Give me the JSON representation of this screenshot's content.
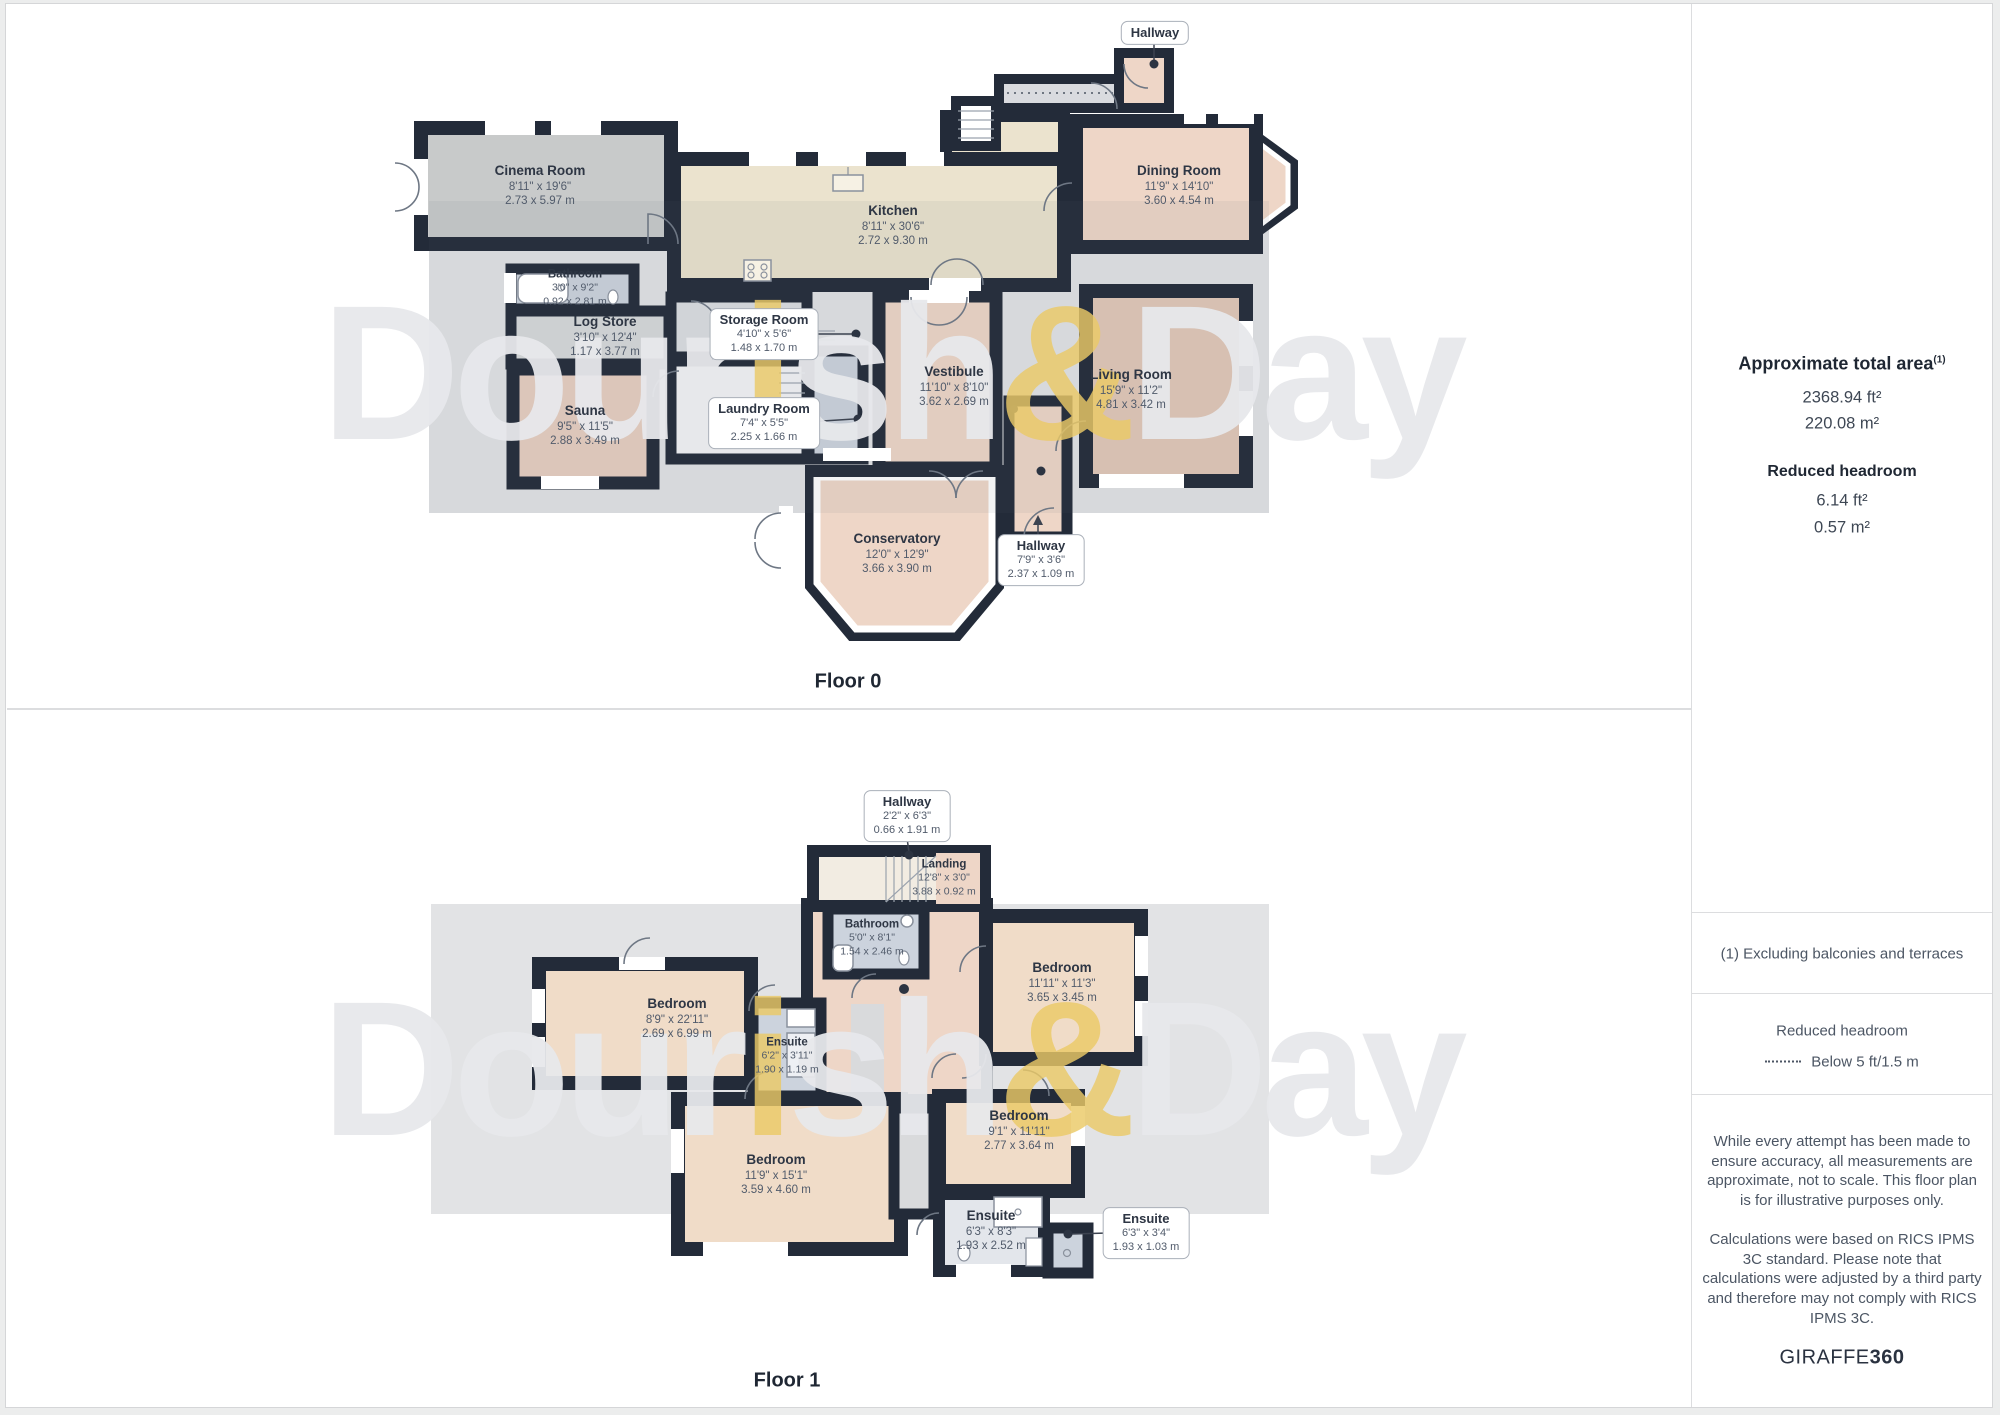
{
  "floor0": {
    "title": "Floor 0",
    "rooms": [
      {
        "name": "Cinema Room",
        "imperial": "8'11\" x 19'6\"",
        "metric": "2.73 x 5.97 m"
      },
      {
        "name": "Kitchen",
        "imperial": "8'11\" x 30'6\"",
        "metric": "2.72 x 9.30 m"
      },
      {
        "name": "Dining Room",
        "imperial": "11'9\" x 14'10\"",
        "metric": "3.60 x 4.54 m"
      },
      {
        "name": "Bathroom",
        "imperial": "3'0\" x 9'2\"",
        "metric": "0.92 x 2.81 m"
      },
      {
        "name": "Log Store",
        "imperial": "3'10\" x 12'4\"",
        "metric": "1.17 x 3.77 m"
      },
      {
        "name": "Sauna",
        "imperial": "9'5\" x 11'5\"",
        "metric": "2.88 x 3.49 m"
      },
      {
        "name": "Vestibule",
        "imperial": "11'10\" x 8'10\"",
        "metric": "3.62 x 2.69 m"
      },
      {
        "name": "Living Room",
        "imperial": "15'9\" x 11'2\"",
        "metric": "4.81 x 3.42 m"
      },
      {
        "name": "Conservatory",
        "imperial": "12'0\" x 12'9\"",
        "metric": "3.66 x 3.90 m"
      }
    ],
    "callouts": [
      {
        "name": "Hallway"
      },
      {
        "name": "Storage Room",
        "imperial": "4'10\" x 5'6\"",
        "metric": "1.48 x 1.70 m"
      },
      {
        "name": "Laundry Room",
        "imperial": "7'4\" x 5'5\"",
        "metric": "2.25 x 1.66 m"
      },
      {
        "name": "Hallway",
        "imperial": "7'9\" x 3'6\"",
        "metric": "2.37 x 1.09 m"
      }
    ]
  },
  "floor1": {
    "title": "Floor 1",
    "rooms": [
      {
        "name": "Bedroom",
        "imperial": "8'9\" x 22'11\"",
        "metric": "2.69 x 6.99 m"
      },
      {
        "name": "Ensuite",
        "imperial": "6'2\" x 3'11\"",
        "metric": "1.90 x 1.19 m"
      },
      {
        "name": "Bathroom",
        "imperial": "5'0\" x 8'1\"",
        "metric": "1.54 x 2.46 m"
      },
      {
        "name": "Landing",
        "imperial": "12'8\" x 3'0\"",
        "metric": "3.88 x 0.92 m"
      },
      {
        "name": "Bedroom",
        "imperial": "11'11\" x 11'3\"",
        "metric": "3.65 x 3.45 m"
      },
      {
        "name": "Bedroom",
        "imperial": "11'9\" x 15'1\"",
        "metric": "3.59 x 4.60 m"
      },
      {
        "name": "Bedroom",
        "imperial": "9'1\" x 11'11\"",
        "metric": "2.77 x 3.64 m"
      },
      {
        "name": "Ensuite",
        "imperial": "6'3\" x 8'3\"",
        "metric": "1.93 x 2.52 m"
      }
    ],
    "callouts": [
      {
        "name": "Hallway",
        "imperial": "2'2\" x 6'3\"",
        "metric": "0.66 x 1.91 m"
      },
      {
        "name": "Ensuite",
        "imperial": "6'3\" x 3'4\"",
        "metric": "1.93 x 1.03 m"
      }
    ]
  },
  "sidebar": {
    "total_area_title": "Approximate total area",
    "total_area_sup": "(1)",
    "total_area_ft": "2368.94 ft²",
    "total_area_m": "220.08 m²",
    "reduced_headroom_title": "Reduced headroom",
    "reduced_headroom_ft": "6.14 ft²",
    "reduced_headroom_m": "0.57 m²",
    "note_exclusions": "(1) Excluding balconies and terraces",
    "legend_title": "Reduced headroom",
    "legend_text": "Below 5 ft/1.5 m",
    "disclaimer1": "While every attempt has been made to ensure accuracy, all measurements are approximate, not to scale. This floor plan is for illustrative purposes only.",
    "disclaimer2": "Calculations were based on RICS IPMS 3C standard. Please note that calculations were adjusted by a third party and therefore may not comply with RICS IPMS 3C.",
    "brand_name": "GIRAFFE",
    "brand_suffix": "360"
  },
  "watermark": {
    "p0": "Dour",
    "p1": "i",
    "p2": "sh",
    "p3": "&",
    "p4": "Day"
  },
  "colors": {
    "wall": "#232b39",
    "pink": "#eed6c7",
    "tan": "#f0dcc8",
    "beige": "#ebe3ce",
    "blue": "#ccd3dd",
    "gray_room": "#c8caca",
    "backdrop": "#e2e3e5",
    "gold": "#eac966"
  }
}
